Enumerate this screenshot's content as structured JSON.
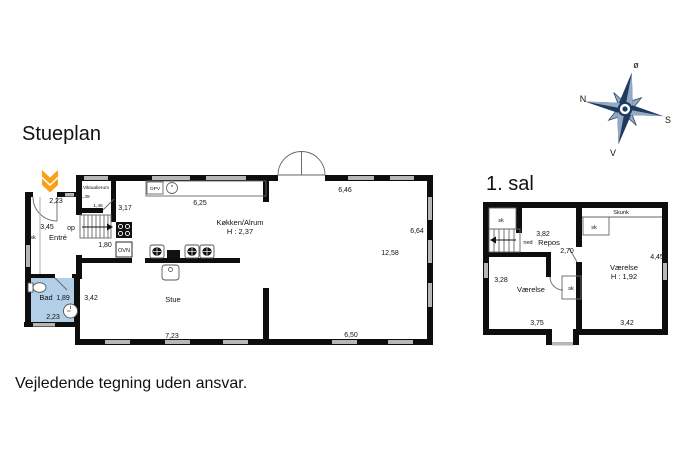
{
  "titles": {
    "ground": "Stueplan",
    "first": "1. sal",
    "disclaimer": "Vejledende tegning uden ansvar."
  },
  "compass": {
    "east": "ø",
    "north": "N",
    "south": "S",
    "west": "V"
  },
  "accent_colors": {
    "entrance_marker": "#F7A11A",
    "compass_navy": "#1e3a5f",
    "compass_light": "#93a9c4",
    "bathroom_fill": "#b3cfe8"
  },
  "ground": {
    "labels": {
      "entre": "Entré",
      "bad": "Bad",
      "stue": "Stue",
      "kitchen": "Køkken/Alrum",
      "kitchen_height": "H : 2,37",
      "pantry": "Viktualierum",
      "oven": "OVN",
      "water_heater": "OPV",
      "stairs_up": "op",
      "closet_entre": "sk",
      "closet_bad": "sk"
    },
    "dims": {
      "entry_width": "2,23",
      "entre_depth": "3,45",
      "pantry_width": "1,39",
      "pantry_depth": "1,46",
      "pantry_side": "3,17",
      "kitchen_side": "1,80",
      "kitchen_top": "6,25",
      "top_right": "6,46",
      "right_side": "6,64",
      "great_room": "12,58",
      "bottom_right": "6,50",
      "bottom_left": "7,23",
      "stue_side": "3,42",
      "bad_width": "1,89",
      "bad_bottom": "2,23"
    }
  },
  "first": {
    "labels": {
      "skunk": "Skunk",
      "closet_stairs": "sk",
      "closet_right": "sk",
      "closet_mid": "sk",
      "stairs_down": "ned",
      "landing": "Repos",
      "room_left": "Værelse",
      "room_right": "Værelse",
      "room_right_height": "H : 1,92"
    },
    "dims": {
      "stairs_width": "3,82",
      "landing_width": "2,70",
      "right_side": "4,45",
      "left_side": "3,28",
      "bottom_left": "3,75",
      "bottom_right": "3,42"
    }
  }
}
